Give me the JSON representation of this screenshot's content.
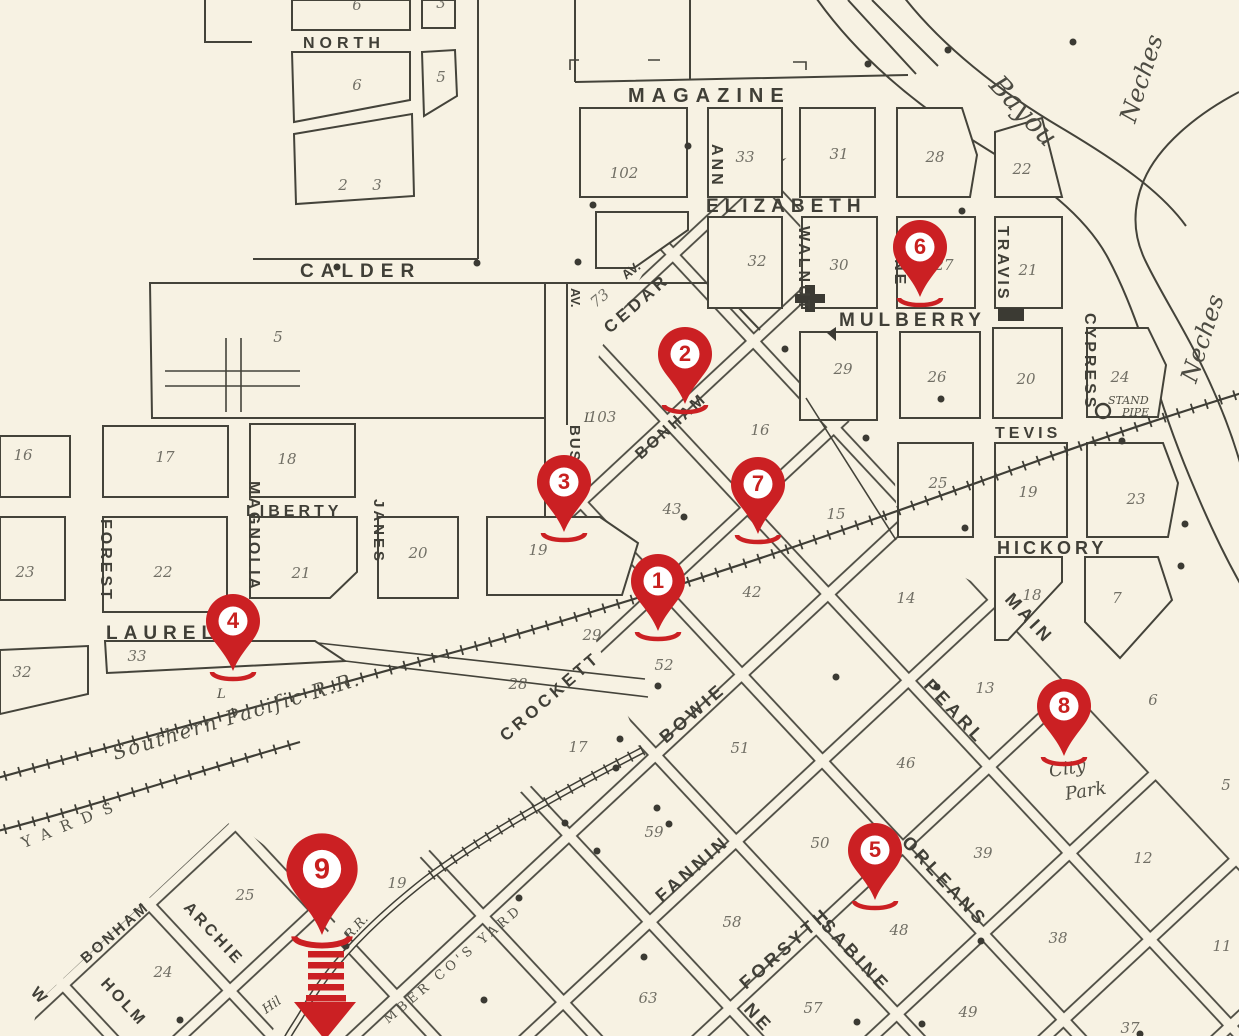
{
  "pins": [
    {
      "label": "1"
    },
    {
      "label": "2"
    },
    {
      "label": "3"
    },
    {
      "label": "4"
    },
    {
      "label": "5"
    },
    {
      "label": "6"
    },
    {
      "label": "7"
    },
    {
      "label": "8"
    },
    {
      "label": "9"
    }
  ],
  "streets": {
    "north": "NORTH",
    "calder": "CALDER",
    "magazine": "MAGAZINE",
    "elizabeth": "ELIZABETH",
    "mulberry": "MULBERRY",
    "tevis": "TEVIS",
    "hickory": "HICKORY",
    "liberty": "LIBERTY",
    "laurel": "LAUREL",
    "ann": "ANN",
    "walnut": "WALNUT",
    "pine": "PINE",
    "travis": "TRAVIS",
    "cypress": "CYPRESS",
    "forest": "FOREST",
    "magnolia": "MAGNOLIA",
    "janes": "JANES",
    "bush": "BUSH",
    "av_bush": "AV.",
    "cedar": "CEDAR",
    "av_cedar": "AV.",
    "bonham_upper": "BONHAM",
    "crockett": "CROCKETT",
    "bowie": "BOWIE",
    "fannin": "FANNIN",
    "forsyth": "FORSYTH",
    "bonham_lower": "BONHAM",
    "archie": "ARCHIE",
    "holm": "HOLM",
    "w": "W",
    "main": "MAIN",
    "pearl": "PEARL",
    "orleans": "ORLEANS",
    "sabine": "SABINE",
    "ne": "NE"
  },
  "waterways": {
    "bayou": "Bayou",
    "neches_a": "Neches",
    "neches_b": "Neches"
  },
  "railroads": {
    "southern_pacific": "Southern Pacific R.R.",
    "rr": "R.R.",
    "hil": "Hil"
  },
  "landmarks": {
    "stand": "STAND",
    "pipe": "PIPE",
    "city": "City",
    "park": "Park",
    "yards": "YARDS",
    "lumber_yard": "MBER CO'S YARD",
    "l_mark": "L",
    "l_mark2": "L"
  },
  "colors": {
    "pin_red": "#cb2023",
    "map_line": "#44433a",
    "paper": "#f7f2e3"
  },
  "map_texts": [
    {
      "t": "6",
      "x": 357,
      "y": 10
    },
    {
      "t": "3",
      "x": 441,
      "y": 8
    },
    {
      "t": "6",
      "x": 357,
      "y": 90
    },
    {
      "t": "5",
      "x": 441,
      "y": 82
    },
    {
      "t": "2",
      "x": 343,
      "y": 190,
      "s": 12
    },
    {
      "t": "3",
      "x": 377,
      "y": 190,
      "s": 12
    },
    {
      "t": "5",
      "x": 278,
      "y": 342
    },
    {
      "t": "102",
      "x": 624,
      "y": 178
    },
    {
      "t": "33",
      "x": 745,
      "y": 162
    },
    {
      "t": "31",
      "x": 839,
      "y": 159
    },
    {
      "t": "28",
      "x": 935,
      "y": 162
    },
    {
      "t": "22",
      "x": 1022,
      "y": 174
    },
    {
      "t": "32",
      "x": 757,
      "y": 266
    },
    {
      "t": "30",
      "x": 839,
      "y": 270
    },
    {
      "t": "27",
      "x": 944,
      "y": 270
    },
    {
      "t": "21",
      "x": 1028,
      "y": 275
    },
    {
      "t": "29",
      "x": 843,
      "y": 374
    },
    {
      "t": "26",
      "x": 937,
      "y": 382
    },
    {
      "t": "20",
      "x": 1026,
      "y": 384
    },
    {
      "t": "24",
      "x": 1120,
      "y": 382
    },
    {
      "t": "25",
      "x": 938,
      "y": 488
    },
    {
      "t": "19",
      "x": 1028,
      "y": 497
    },
    {
      "t": "23",
      "x": 1136,
      "y": 504
    },
    {
      "t": "18",
      "x": 1032,
      "y": 600
    },
    {
      "t": "7",
      "x": 1117,
      "y": 603
    },
    {
      "t": "14",
      "x": 906,
      "y": 603
    },
    {
      "t": "16",
      "x": 23,
      "y": 460
    },
    {
      "t": "17",
      "x": 165,
      "y": 462
    },
    {
      "t": "18",
      "x": 287,
      "y": 464
    },
    {
      "t": "23",
      "x": 25,
      "y": 577
    },
    {
      "t": "22",
      "x": 163,
      "y": 577
    },
    {
      "t": "21",
      "x": 301,
      "y": 578
    },
    {
      "t": "20",
      "x": 418,
      "y": 558
    },
    {
      "t": "19",
      "x": 538,
      "y": 555
    },
    {
      "t": "33",
      "x": 137,
      "y": 661
    },
    {
      "t": "32",
      "x": 22,
      "y": 677
    },
    {
      "t": "73",
      "x": 603,
      "y": 302,
      "r": -40
    },
    {
      "t": "103",
      "x": 602,
      "y": 422
    },
    {
      "t": "16",
      "x": 760,
      "y": 435
    },
    {
      "t": "43",
      "x": 672,
      "y": 514
    },
    {
      "t": "15",
      "x": 836,
      "y": 519
    },
    {
      "t": "29",
      "x": 592,
      "y": 640,
      "s": 12
    },
    {
      "t": "52",
      "x": 664,
      "y": 670
    },
    {
      "t": "28",
      "x": 518,
      "y": 689
    },
    {
      "t": "17",
      "x": 578,
      "y": 752
    },
    {
      "t": "42",
      "x": 752,
      "y": 597
    },
    {
      "t": "51",
      "x": 740,
      "y": 753
    },
    {
      "t": "46",
      "x": 906,
      "y": 768
    },
    {
      "t": "13",
      "x": 985,
      "y": 693
    },
    {
      "t": "6",
      "x": 1153,
      "y": 705
    },
    {
      "t": "5",
      "x": 1226,
      "y": 790
    },
    {
      "t": "12",
      "x": 1143,
      "y": 863
    },
    {
      "t": "11",
      "x": 1222,
      "y": 951
    },
    {
      "t": "38",
      "x": 1058,
      "y": 943
    },
    {
      "t": "39",
      "x": 983,
      "y": 858
    },
    {
      "t": "50",
      "x": 820,
      "y": 848
    },
    {
      "t": "59",
      "x": 654,
      "y": 837
    },
    {
      "t": "58",
      "x": 732,
      "y": 927
    },
    {
      "t": "48",
      "x": 899,
      "y": 935
    },
    {
      "t": "57",
      "x": 813,
      "y": 1013
    },
    {
      "t": "49",
      "x": 968,
      "y": 1017
    },
    {
      "t": "63",
      "x": 648,
      "y": 1003
    },
    {
      "t": "37",
      "x": 1130,
      "y": 1033
    },
    {
      "t": "25",
      "x": 245,
      "y": 900
    },
    {
      "t": "19",
      "x": 397,
      "y": 888
    },
    {
      "t": "24",
      "x": 163,
      "y": 977
    }
  ],
  "dots": [
    [
      337,
      267
    ],
    [
      477,
      263
    ],
    [
      578,
      262
    ],
    [
      868,
      64
    ],
    [
      948,
      50
    ],
    [
      1073,
      42
    ],
    [
      688,
      146
    ],
    [
      593,
      205
    ],
    [
      962,
      211
    ],
    [
      785,
      349
    ],
    [
      941,
      399
    ],
    [
      866,
      438
    ],
    [
      1122,
      441
    ],
    [
      1185,
      524
    ],
    [
      965,
      528
    ],
    [
      684,
      517
    ],
    [
      658,
      686
    ],
    [
      620,
      739
    ],
    [
      616,
      768
    ],
    [
      836,
      677
    ],
    [
      937,
      687
    ],
    [
      1066,
      694
    ],
    [
      876,
      868
    ],
    [
      981,
      941
    ],
    [
      857,
      1022
    ],
    [
      922,
      1024
    ],
    [
      1140,
      1034
    ],
    [
      657,
      808
    ],
    [
      669,
      824
    ],
    [
      565,
      823
    ],
    [
      597,
      851
    ],
    [
      519,
      898
    ],
    [
      484,
      1000
    ],
    [
      644,
      957
    ],
    [
      180,
      1020
    ],
    [
      346,
      946
    ],
    [
      1181,
      566
    ]
  ]
}
